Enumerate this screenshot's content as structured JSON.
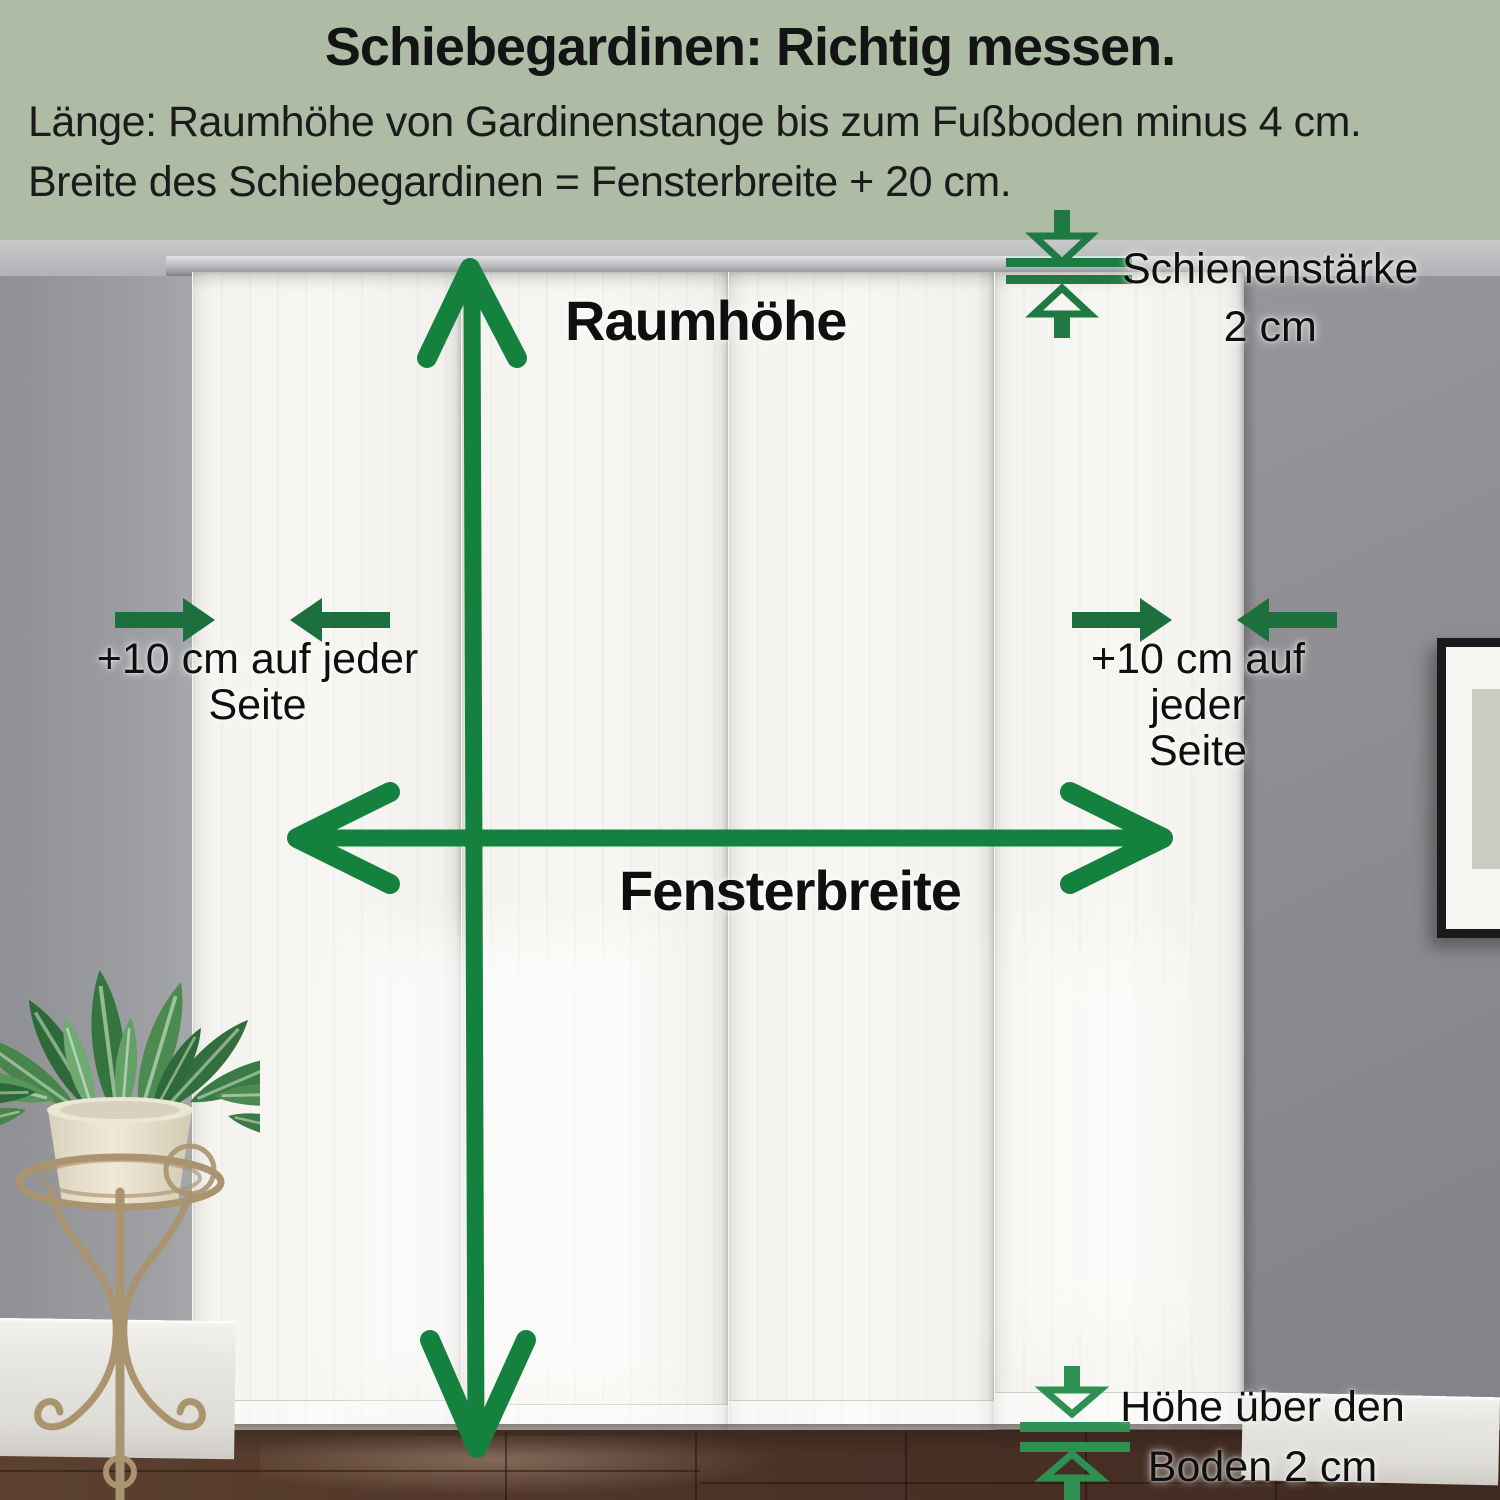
{
  "header": {
    "title": "Schiebegardinen: Richtig messen.",
    "line1": "Länge: Raumhöhe von Gardinenstange bis zum Fußboden minus 4 cm.",
    "line2": "Breite des Schiebegardinen = Fensterbreite + 20 cm.",
    "background_color": "#aebca6"
  },
  "annotations": {
    "room_height": {
      "label": "Raumhöhe"
    },
    "window_width": {
      "label": "Fensterbreite"
    },
    "rail_thickness": {
      "line1": "Schienenstärke",
      "line2": "2 cm"
    },
    "left_side_allowance": {
      "line1": "+10 cm auf jeder",
      "line2": "Seite"
    },
    "right_side_allowance": {
      "line1": "+10 cm auf jeder",
      "line2": "Seite"
    },
    "floor_clearance": {
      "line1": "Höhe über den",
      "line2": "Boden 2 cm"
    }
  },
  "colors": {
    "header_background": "#aebca6",
    "arrow_green": "#15813f",
    "solid_arrow_green": "#1e6f3e",
    "gap_symbol_green_top": "#1e7a41",
    "gap_symbol_green_bottom": "#2e9152",
    "label_text": "#0f0f0f"
  },
  "scene": {
    "curtain_panels": 4,
    "objects": [
      "curtain-rail",
      "sliding-curtain-panels",
      "potted-plant",
      "metal-plant-stand",
      "picture-frame",
      "marble-baseboard",
      "dark-tile-floor"
    ]
  }
}
